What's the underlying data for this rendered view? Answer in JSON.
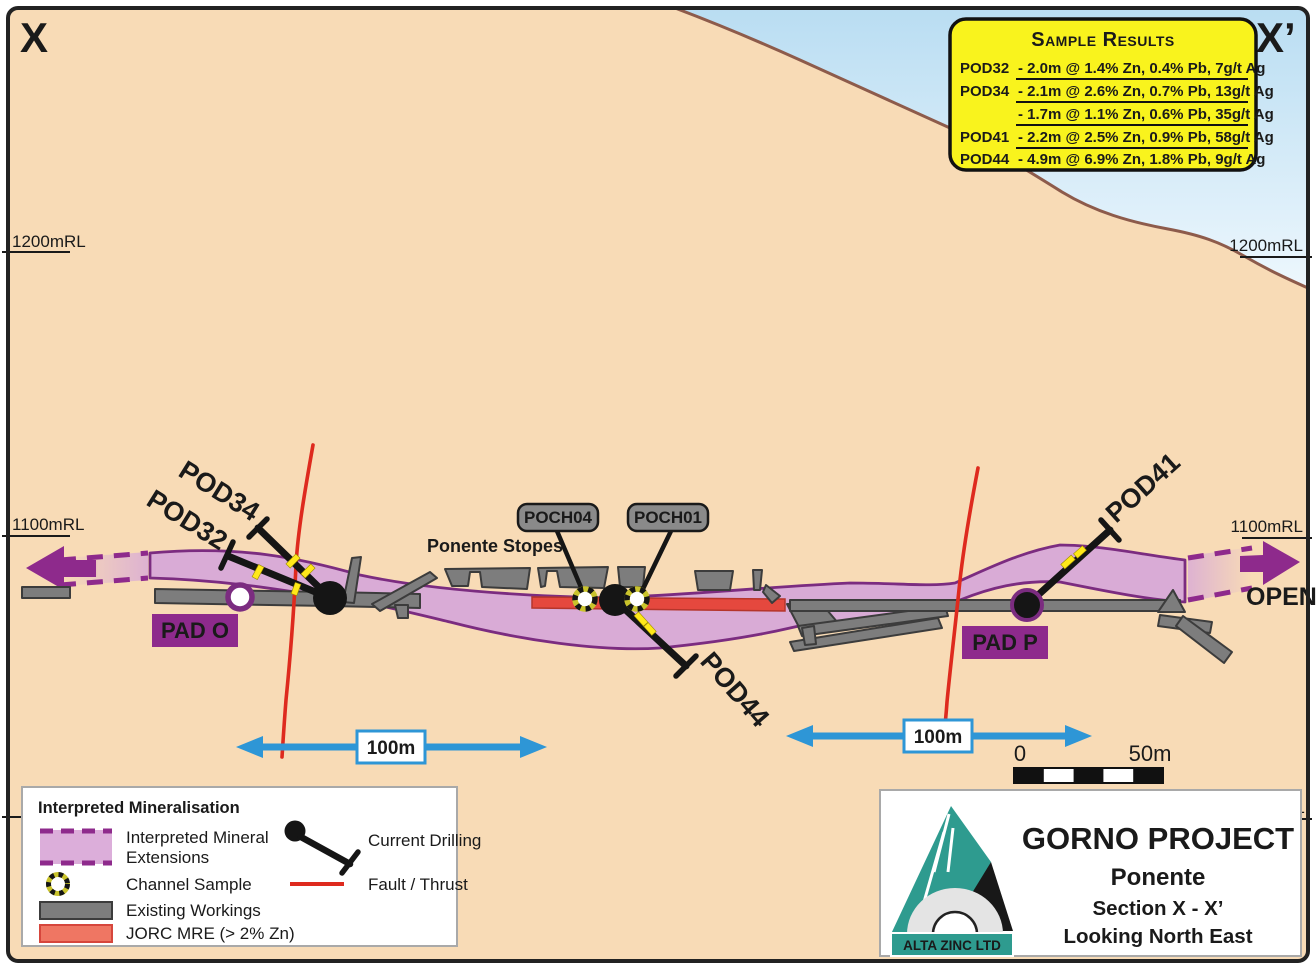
{
  "section": {
    "left_marker": "X",
    "right_marker": "X’"
  },
  "sample_results": {
    "title": "Sample Results",
    "rows": [
      {
        "hole": "POD32",
        "result": "- 2.0m @ 1.4% Zn, 0.4% Pb, 7g/t Ag"
      },
      {
        "hole": "POD34",
        "result": "- 2.1m @ 2.6% Zn, 0.7% Pb, 13g/t Ag"
      },
      {
        "hole": "",
        "result": "- 1.7m @ 1.1% Zn, 0.6% Pb, 35g/t Ag"
      },
      {
        "hole": "POD41",
        "result": "- 2.2m @ 2.5% Zn, 0.9% Pb, 58g/t Ag"
      },
      {
        "hole": "POD44",
        "result": "- 4.9m @ 6.9% Zn, 1.8% Pb, 9g/t Ag"
      }
    ]
  },
  "elevations": {
    "left_1200": "1200mRL",
    "right_1200": "1200mRL",
    "left_1100": "1100mRL",
    "right_1100": "1100mRL",
    "right_1000_partial": "RL"
  },
  "drill_labels": {
    "pod32": "POD32",
    "pod34": "POD34",
    "pod41": "POD41",
    "pod44": "POD44"
  },
  "channel_labels": {
    "poch04": "POCH04",
    "poch01": "POCH01"
  },
  "annotations": {
    "ponente_stopes": "Ponente Stopes",
    "pad_o": "PAD O",
    "pad_p": "PAD P",
    "open": "OPEN"
  },
  "scale": {
    "arrow_left_label": "100m",
    "arrow_right_label": "100m",
    "bar_zero": "0",
    "bar_max": "50m"
  },
  "legend": {
    "title": "Interpreted Mineralisation",
    "mineral_ext_line1": "Interpreted Mineral",
    "mineral_ext_line2": "Extensions",
    "channel_sample": "Channel Sample",
    "existing_workings": "Existing Workings",
    "jorc_mre": "JORC MRE (> 2% Zn)",
    "current_drilling": "Current Drilling",
    "fault_thrust": "Fault / Thrust"
  },
  "title_block": {
    "company": "ALTA ZINC LTD",
    "project": "GORNO PROJECT",
    "area": "Ponente",
    "section": "Section X - X’",
    "view": "Looking North East"
  },
  "colors": {
    "ground": "#f8dbb6",
    "sky_top": "#b9ddf2",
    "sky_bottom": "#edf7fd",
    "terrain_line": "#8d5b4b",
    "mineral_fill": "#d9abd6",
    "mineral_edge": "#7b2c80",
    "purple_accent": "#8e2a8c",
    "jorc_red": "#e5483e",
    "workings_gray": "#7d7d7d",
    "fault_red": "#de2a1e",
    "scale_blue": "#2e96d6",
    "sample_box_yellow": "#f9f31d",
    "intercept_yellow": "#ffe819",
    "title_red": "#d6251d",
    "logo_teal": "#2e9b8f"
  }
}
